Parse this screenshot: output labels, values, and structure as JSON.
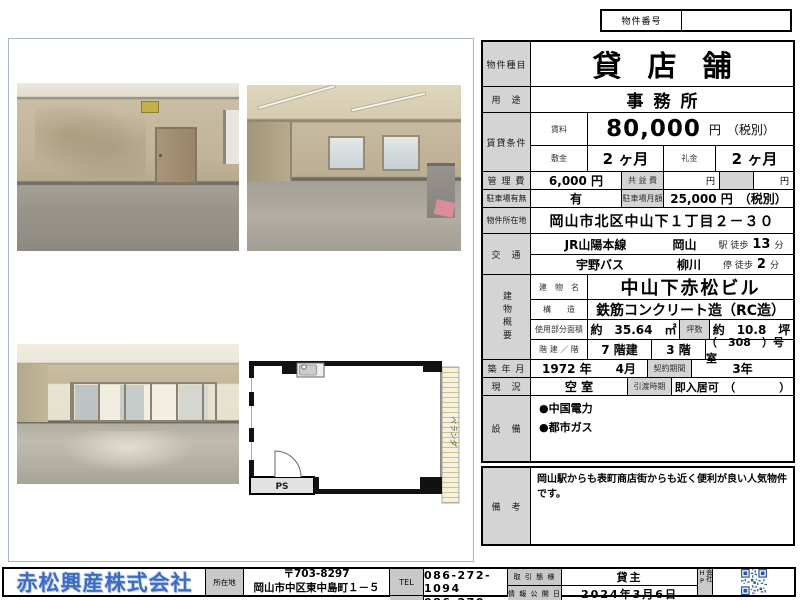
{
  "header": {
    "property_no_label": "物件番号",
    "property_no_value": ""
  },
  "table": {
    "type_label": "物件種目",
    "type_value": "貸店舗",
    "use_label": "用　途",
    "use_value": "事務所",
    "cond_label": "賃貸条件",
    "rent_label": "賃料",
    "rent_value": "80,000",
    "rent_suffix": "円　（税別）",
    "deposit_label": "敷金",
    "deposit_value": "2 ヶ月",
    "keymoney_label": "礼金",
    "keymoney_value": "2 ヶ月",
    "mgmt_label": "管 理 費",
    "mgmt_value": "6,000 円",
    "kyoeki_label": "共 益 費",
    "kyoeki_unit": "円",
    "other_unit": "円",
    "parking_label": "駐車場有無",
    "parking_value": "有",
    "parking_fee_label": "駐車場月額",
    "parking_fee_value": "25,000 円　（税別）",
    "addr_label": "物件所在地",
    "addr_value": "岡山市北区中山下１丁目２－３０",
    "traffic_label": "交　通",
    "t1_line": "JR山陽本線",
    "t1_sta": "岡山",
    "t1_walk": "駅 徒歩",
    "t1_min": "13",
    "t1_unit": "分",
    "t2_line": "宇野バス",
    "t2_sta": "柳川",
    "t2_walk": "停 徒歩",
    "t2_min": "2",
    "t2_unit": "分",
    "bldg_label": "建物概要",
    "bname_label": "建　物　名",
    "bname_value": "中山下赤松ビル",
    "struct_label": "構　　造",
    "struct_value": "鉄筋コンクリート造（RC造）",
    "area_label": "使用部分面積",
    "area_value": "約　35.64　㎡",
    "tsubo_label": "坪数",
    "tsubo_value": "約　10.8　坪",
    "floors_label": "階 建 ／ 階",
    "floors_value": "7 階建",
    "floor_value": "3 階",
    "room_value": "（　308　）号室",
    "built_label": "築 年 月",
    "built_value": "1972 年　　4月",
    "contract_label": "契約期間",
    "contract_value": "3年",
    "status_label": "現　況",
    "status_value": "空 室",
    "handover_label": "引渡時期",
    "handover_value": "即入居可　（　　　　）",
    "equip_label": "設　備",
    "equip_items": [
      "●中国電力",
      "●都市ガス"
    ],
    "remarks_label": "備　考",
    "remarks_value": "岡山駅からも表町商店街からも近く便利が良い人気物件です。"
  },
  "floorplan": {
    "balcony_label": "ベランダ",
    "ps_label": "PS"
  },
  "footer": {
    "company": "赤松興産株式会社",
    "addr_label": "所在地",
    "zip": "〒703-8297",
    "address": "岡山市中区東中島町１－５",
    "tel_label": "TEL",
    "tel": "086-272-1094",
    "fax_label": "FAX",
    "fax": "086-270-0220",
    "deal_label": "取 引 態 様",
    "deal": "貸主",
    "date_label": "情 報 公 開 日",
    "date": "2024年3月6日",
    "hp_label": "会社HP"
  },
  "colors": {
    "brand_blue": "#3e6cc0",
    "qr_blue": "#2b56a5",
    "label_gray": "#d4d4d4"
  }
}
